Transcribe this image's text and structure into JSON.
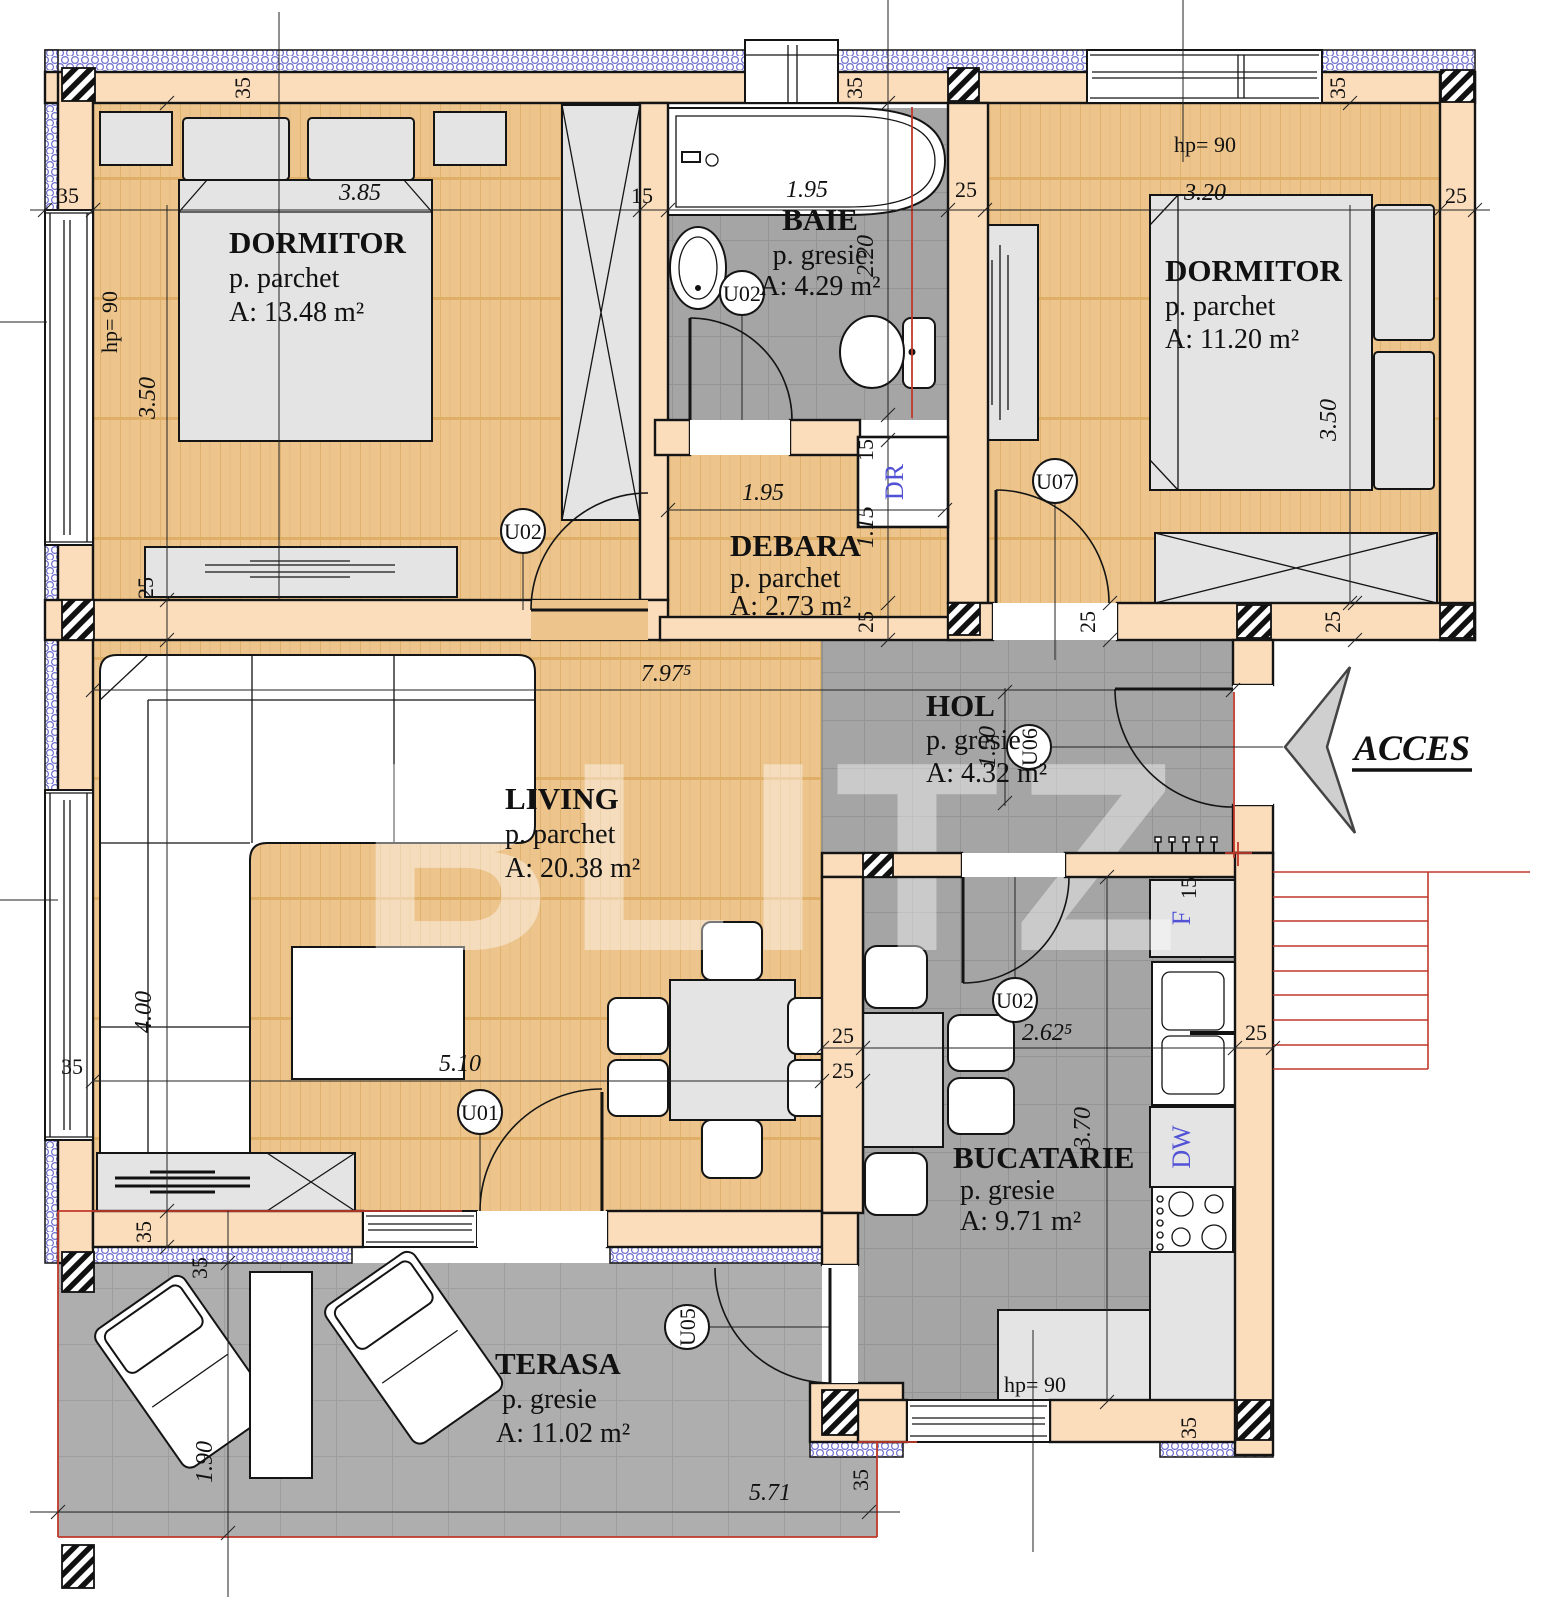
{
  "watermark": "BLITZ",
  "access": {
    "label": "ACCES"
  },
  "rooms": [
    {
      "id": "dormitor1",
      "name": "DORMITOR",
      "finish": "p. parchet",
      "area": "A: 13.48 m²"
    },
    {
      "id": "baie",
      "name": "BAIE",
      "finish": "p. gresie",
      "area": "A: 4.29 m²"
    },
    {
      "id": "dormitor2",
      "name": "DORMITOR",
      "finish": "p. parchet",
      "area": "A: 11.20 m²"
    },
    {
      "id": "debara",
      "name": "DEBARA",
      "finish": "p. parchet",
      "area": "A: 2.73 m²"
    },
    {
      "id": "hol",
      "name": "HOL",
      "finish": "p. gresie",
      "area": "A: 4.32 m²"
    },
    {
      "id": "living",
      "name": "LIVING",
      "finish": "p. parchet",
      "area": "A: 20.38 m²"
    },
    {
      "id": "bucatarie",
      "name": "BUCATARIE",
      "finish": "p. gresie",
      "area": "A: 9.71 m²"
    },
    {
      "id": "terasa",
      "name": "TERASA",
      "finish": "p. gresie",
      "area": "A: 11.02 m²"
    }
  ],
  "doors": {
    "u01": "U01",
    "u02": "U02",
    "u05": "U05",
    "u06": "U06",
    "u07": "U07"
  },
  "labels": {
    "dr": "DR",
    "fridge": "F",
    "dishwasher": "DW"
  },
  "dims": {
    "t35": "35",
    "t25": "25",
    "t15": "15",
    "d385": "3.85",
    "d195": "1.95",
    "d320": "3.20",
    "d350": "3.50",
    "d220": "2.20",
    "d115": "1.15",
    "d797": "7.97⁵",
    "d400": "4.00",
    "d510": "5.10",
    "d262": "2.62⁵",
    "d370": "3.70",
    "d190": "1.90",
    "d571": "5.71",
    "d150": "1.50",
    "hp": "hp= 90"
  },
  "colors": {
    "parquet": "#ecc48c",
    "tile": "#a5a5a5",
    "terrace_tile": "#aeaeae",
    "wall": "#fbdcbb",
    "insulation_blue": "#6f6fd0",
    "red": "#c0392b",
    "label_blue": "#5252d6",
    "furniture_gray": "#e4e4e4"
  }
}
